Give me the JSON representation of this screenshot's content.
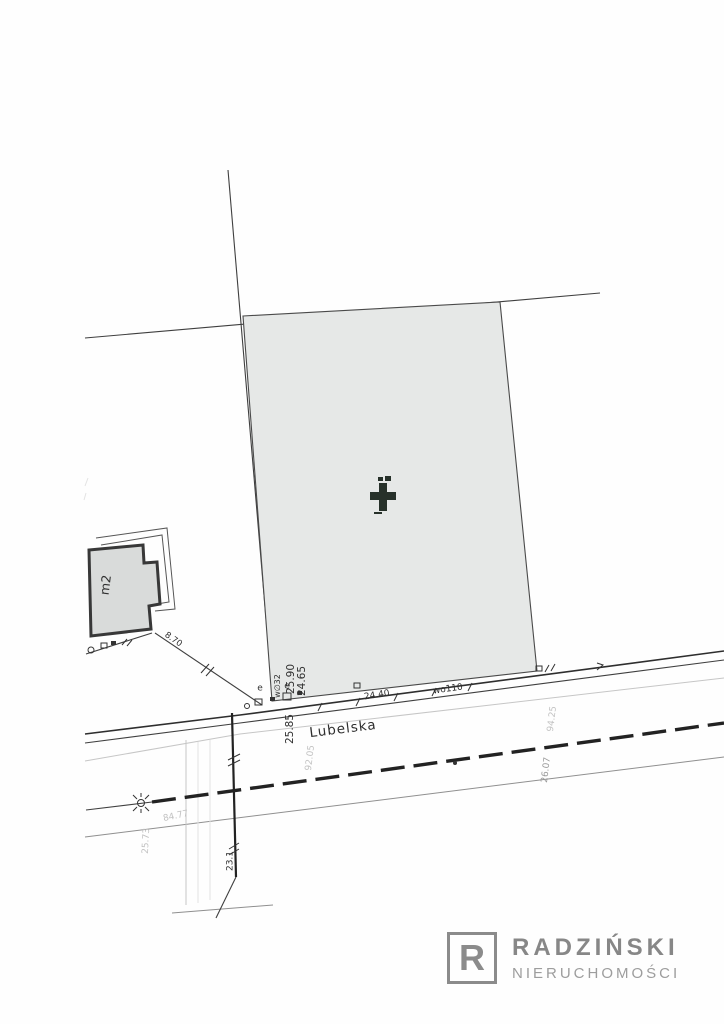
{
  "map": {
    "street": {
      "name": "Lubelska"
    },
    "building": {
      "area_label": "m2"
    },
    "symbols": {
      "cross_marker": "bold-cross-icon",
      "lamp": "circle-with-rays-icon",
      "utility_point": "small-square-icon",
      "boundary_point": "small-circle-icon"
    },
    "colors": {
      "parcel_fill": "#e6e8e7",
      "building_fill": "#d9dbda",
      "line": "#3f3f3f",
      "logo_gray": "#8b8b8b"
    }
  },
  "labels": [
    {
      "id": "dim-25-90",
      "text": "25.90"
    },
    {
      "id": "dim-24-65",
      "text": "24.65"
    },
    {
      "id": "dim-25-85",
      "text": "25.85"
    },
    {
      "id": "dim-24-40",
      "text": "24.40"
    },
    {
      "id": "util-wo110",
      "text": "wo110"
    },
    {
      "id": "util-w32",
      "text": "w∅32"
    },
    {
      "id": "dim-8-70",
      "text": "8.70"
    },
    {
      "id": "dim-92-05",
      "text": "92.05"
    },
    {
      "id": "dim-94-25",
      "text": "94.25"
    },
    {
      "id": "dim-26-07",
      "text": "26.07"
    },
    {
      "id": "dim-84-77",
      "text": "84.77"
    },
    {
      "id": "dim-25-73",
      "text": "25.73"
    },
    {
      "id": "dim-23-1",
      "text": "23.1"
    },
    {
      "id": "util-e-1",
      "text": "e"
    },
    {
      "id": "util-e-2",
      "text": "e"
    }
  ],
  "logo": {
    "initial": "R",
    "brand": "RADZIŃSKI",
    "tagline": "NIERUCHOMOŚCI"
  }
}
